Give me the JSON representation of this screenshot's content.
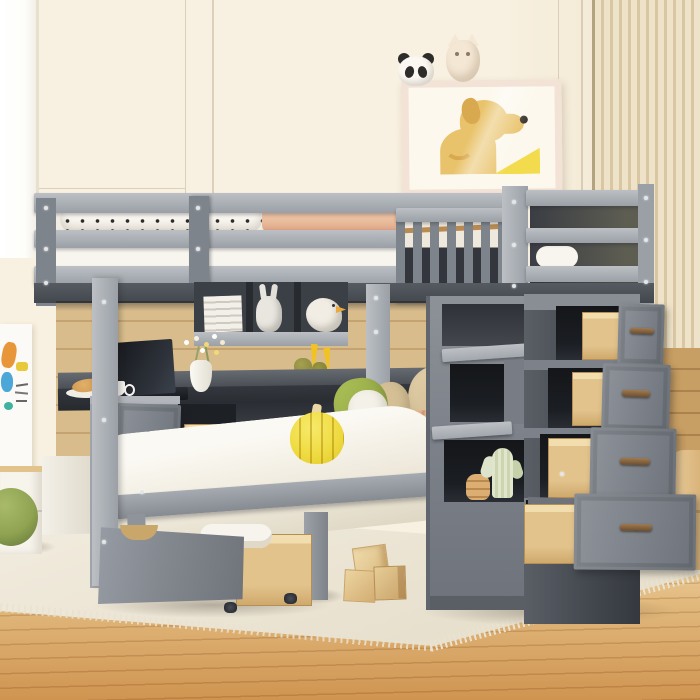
{
  "meta": {
    "domain": "Natural-Image",
    "description": "Lifestyle product photo: gray wooden full-over-twin loft bunk bed with built-in desk, hanging bookshelves, rolling under-bed storage drawer and a storage staircase with four open pull-out drawers, staged in a child's bedroom with cream paneled walls, a wood slat accent wall, framed dog artwork, light oak plank floor and an ivory fringed rug."
  },
  "palette": {
    "wall": "#f8f0e0",
    "wallRight": "#efe4cc",
    "windowWhite": "#fdfdfa",
    "slat": "#eee3c8",
    "slatLine": "#d8c7a2",
    "slatEdge": "#b3a480",
    "woodWall": "#d8bc8b",
    "woodWallDark": "#c79e63",
    "floorTop": "#eed7a6",
    "floorMid": "#e2bb80",
    "floorBottom": "#cf9450",
    "rug": "#f2ecdf",
    "rugDark": "#e3dbc6",
    "fringe": "#eae2d0",
    "bedGray": "#9aa0a6",
    "bedGrayLight": "#bcc0c5",
    "bedGrayMid": "#7e848b",
    "bedGrayDark": "#43474e",
    "towerSlot": "#1b1e23",
    "drawerGrayA": "#8f949b",
    "drawerGrayB": "#6e737b",
    "woodBoxLight": "#f2ddae",
    "woodBoxMid": "#e2c38c",
    "woodBoxDark": "#cfa96c",
    "woodBoxEdge": "#b58e55",
    "handle": "#6b4e30",
    "handleLight": "#a07a50",
    "beddingWhite": "#f8f5ee",
    "peach": "#e9bb9b",
    "peachDark": "#d89a7c",
    "green": "#a3b953",
    "greenDark": "#889c3a",
    "tan": "#dcc8a4",
    "tanDark": "#cdb68c",
    "pumpkin": "#eeda3f",
    "pumpkinHi": "#f7ea6a",
    "pumpkinLine": "#ba9e1a",
    "pumpkinStem": "#ead9a4",
    "duckYellow": "#f2c320",
    "cactus": "#dde4cb",
    "cactusDark": "#c6d1aa",
    "rings": "#d2a266",
    "artFrame": "#f3e2d6",
    "artPaper": "#fcf8ed",
    "dogTan": "#e9c36b",
    "dogDark": "#d9a94f",
    "artYellow": "#f2dc4e",
    "pandaBlack": "#2e2c2a",
    "owlCream": "#f4e7d4",
    "poufGreen": "#8fa352",
    "poufDark": "#66783a",
    "posterOrange": "#e8963a",
    "posterBlue": "#4aa7d8",
    "posterYellow": "#e8c93c",
    "posterTeal": "#3fb3a0",
    "laptopDark": "#16181d",
    "deskTopGray": "#4a4e54",
    "deskEdgeDark": "#26292e",
    "boltWhite": "#e3e6e9"
  },
  "scene": {
    "bed": {
      "label": "gray full-over-twin loft bunk bed",
      "top_bunk_bedding": [
        "white duvet",
        "black-and-white polka-dot bolster pillow",
        "peach blanket"
      ],
      "twin_bedding": [
        "white duvet",
        "peach blanket",
        "two green pillows",
        "tan pillows",
        "white pillow",
        "yellow plush pumpkin"
      ]
    },
    "desk": {
      "items": [
        "black laptop",
        "white coffee cup",
        "croissant on plate",
        "white vase with tiny flowers"
      ],
      "drawer_state": "one drawer pulled open with round black knob"
    },
    "shelf": {
      "items": [
        "stack of white books",
        "bunny figurine",
        "seagull figurine with dangling yellow legs",
        "book stack",
        "olive pear ornaments"
      ]
    },
    "staircase": {
      "drawers_open": 4,
      "drawer_handles": "bronze bar pulls",
      "cubby_items": [
        "plush cactus",
        "wooden ring stacker toy"
      ]
    },
    "storage": {
      "underbed_drawer": "rolled out on casters, holding white towels",
      "pedestal_drawers": "open showing natural wood boxes"
    },
    "decor": {
      "wall_art": "tan dog illustration in cream frame",
      "frame_toppers": [
        "panda plush",
        "owl plush"
      ],
      "left_wall": "children's drawing poster",
      "floor_toys": [
        "wooden alphabet blocks"
      ],
      "seating": "green pouf",
      "right_furniture": "light wood rounded cabinet"
    },
    "room": [
      "cream paneled wall",
      "white window light at left",
      "vertical wood slat accent wall at right",
      "oak plank wall panel behind bed",
      "light oak floor",
      "ivory fringed area rug"
    ]
  }
}
